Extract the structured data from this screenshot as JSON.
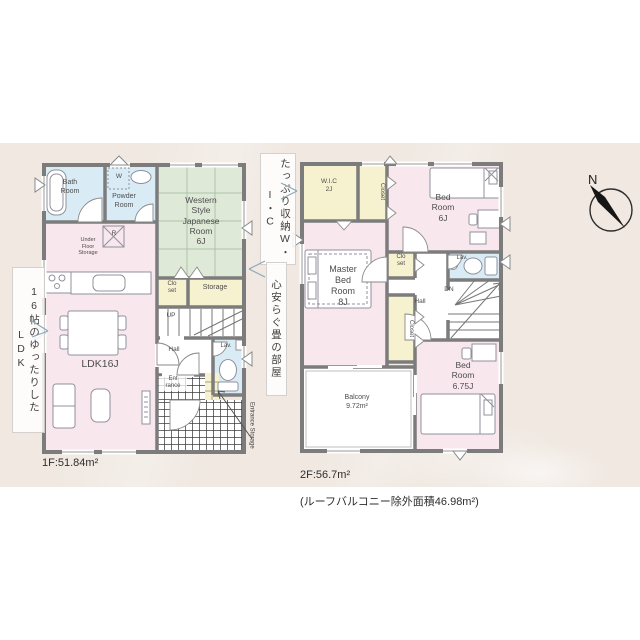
{
  "palette": {
    "band_bg": "#f0e8e1",
    "room_pink": "#f8e7ed",
    "room_blue": "#d9ecf6",
    "room_green": "#dfe9d8",
    "room_yellow": "#f6f1cf",
    "room_white": "#ffffff",
    "wall_gray": "#7c7c7c",
    "furniture_line": "#90909c",
    "callout_arrow": "#8aa8b8"
  },
  "floor1": {
    "area": "1F:51.84m²",
    "labels": {
      "bath": "Bath\nRoom",
      "washer": "W",
      "powder": "Powder\nRoom",
      "japanese": "Western\nStyle\nJapanese\nRoom\n6J",
      "fridge": "R",
      "under_floor": "Under\nFloor\nStorage",
      "closet": "Clo\nset",
      "storage": "Storage",
      "stairs_up": "UP",
      "hall": "Hall",
      "lav": "Lav.",
      "entrance": "Ent\nrance",
      "ldk": "LDK16J",
      "entrance_storage": "Entrance Storage"
    }
  },
  "floor2": {
    "area": "2F:56.7m²",
    "area_note": "(ルーフバルコニー除外面積46.98m²)",
    "labels": {
      "wic": "W.I.C\n2J",
      "closet_top": "Closet",
      "bed6": "Bed\nRoom\n6J",
      "master": "Master\nBed\nRoom\n8J",
      "closet_small": "Clo\nset",
      "hall": "Hall",
      "lav": "Lav.",
      "stairs_dn": "DN",
      "closet_side": "Closet",
      "balcony": "Balcony\n9.72m²",
      "bed675": "Bed\nRoom\n6.75J"
    }
  },
  "callouts": {
    "ldk": "16帖のゆったりしたLDK",
    "wic": "たっぷり収納W・I・C",
    "tatami": "心安らぐ畳の部屋"
  },
  "compass": {
    "north": "N"
  }
}
